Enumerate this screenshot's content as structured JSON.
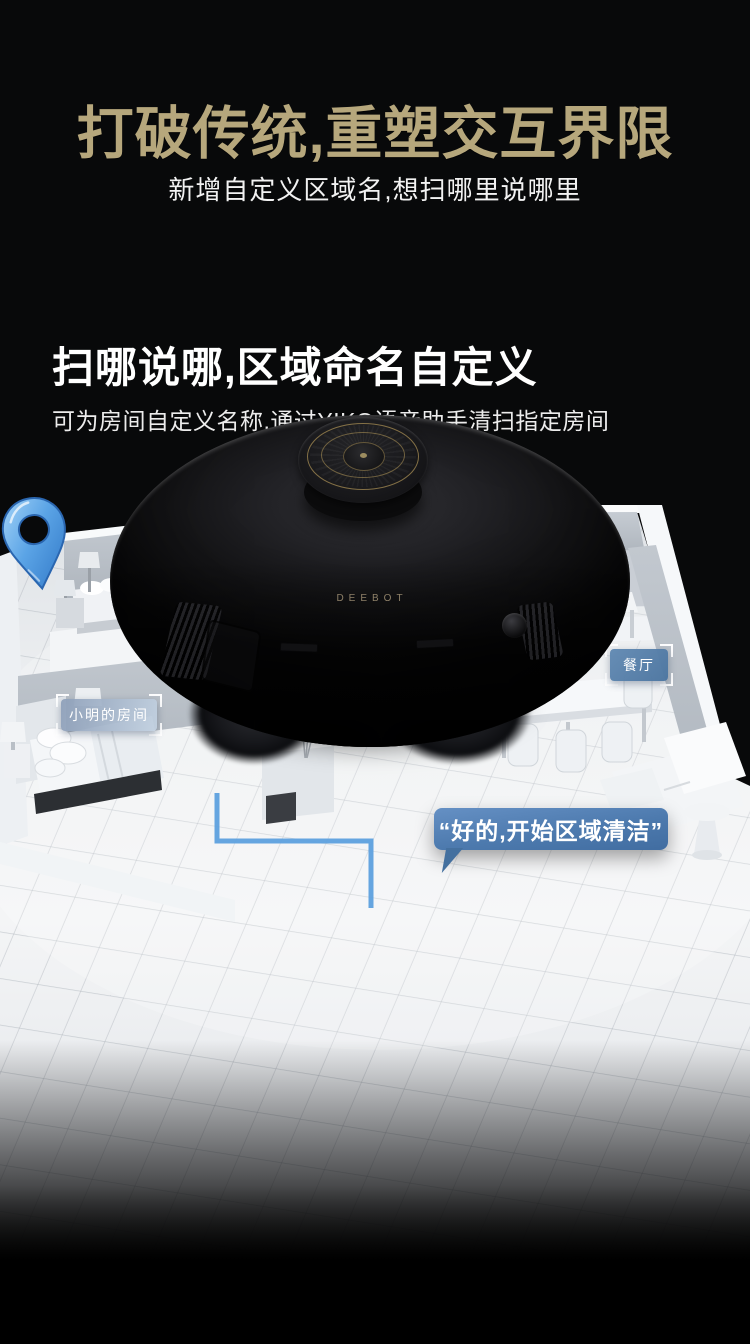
{
  "hero": {
    "title": "打破传统,重塑交互界限",
    "subtitle": "新增自定义区域名,想扫哪里说哪里",
    "title_color": "#b6a77c"
  },
  "feature": {
    "heading": "扫哪说哪,区域命名自定义",
    "description": "可为房间自定义名称,通过YIKO语音助手清扫指定房间"
  },
  "floorplan": {
    "labels": {
      "bedroom": "卧室",
      "xiaoming_room": "小明的房间",
      "dining": "餐厅"
    },
    "bubbles": {
      "command": "“OK YIKO,去扫小明的房间”",
      "reply": "“好的,开始区域清洁”"
    },
    "bubble_blue": "#4d7aae",
    "pin_blue": "#5ba4e6",
    "line_blue": "#5da0de"
  },
  "robot": {
    "brand": "DEEBOT",
    "brand_color": "#8e8068",
    "accent_gold": "#96804e"
  }
}
